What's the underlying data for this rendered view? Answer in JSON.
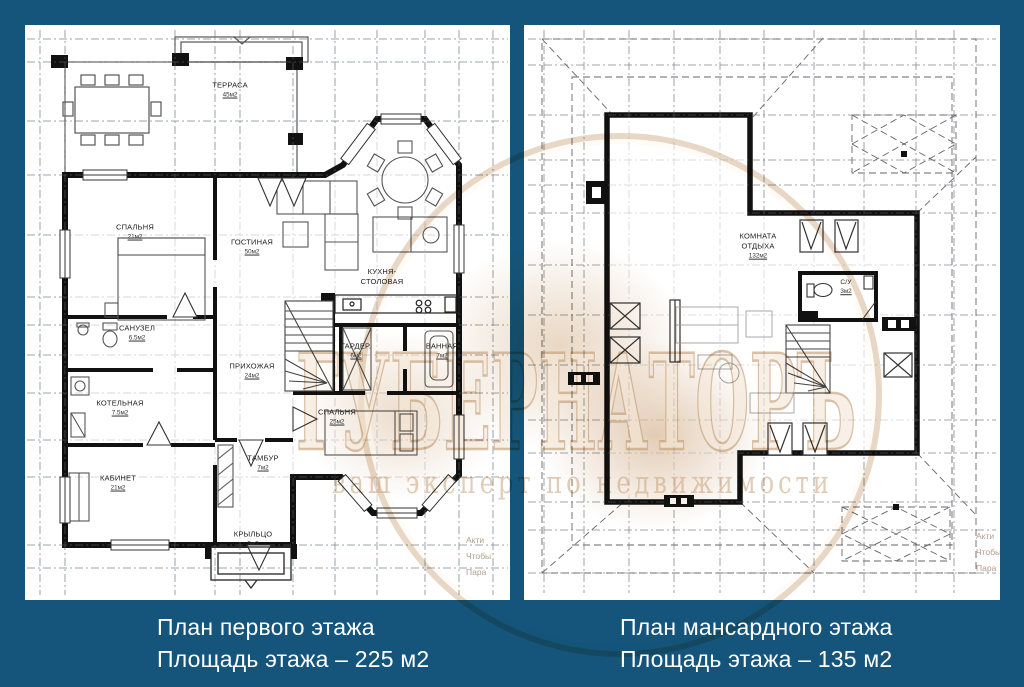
{
  "colors": {
    "background": "#15557C",
    "panel": "#FFFFFF",
    "walls": "#111111",
    "watermark_tan": "#C69C6E",
    "caption_text": "#FFFFFF"
  },
  "left_plan": {
    "caption_line1": "План первого этажа",
    "caption_line2": "Площадь этажа – 225 м2",
    "rooms": [
      {
        "name": "ТЕРРАСА",
        "area": "45м2"
      },
      {
        "name": "СПАЛЬНЯ",
        "area": "21м2"
      },
      {
        "name": "ГОСТИНАЯ",
        "area": "50м2"
      },
      {
        "name": "КУХНЯ-СТОЛОВАЯ",
        "area": ""
      },
      {
        "name": "САНУЗЕЛ",
        "area": "6.5м2"
      },
      {
        "name": "ПРИХОЖАЯ",
        "area": "24м2"
      },
      {
        "name": "ГАРДЕР.",
        "area": "6м2"
      },
      {
        "name": "ВАННАЯ",
        "area": "7м2"
      },
      {
        "name": "КОТЕЛЬНАЯ",
        "area": "7.5м2"
      },
      {
        "name": "СПАЛЬНЯ",
        "area": "25м2"
      },
      {
        "name": "КАБИНЕТ",
        "area": "21м2"
      },
      {
        "name": "ТАМБУР",
        "area": "7м2"
      },
      {
        "name": "КРЫЛЬЦО",
        "area": "5м2"
      }
    ]
  },
  "right_plan": {
    "caption_line1": "План мансардного этажа",
    "caption_line2": "Площадь этажа – 135 м2",
    "rooms": [
      {
        "name": "КОМНАТА ОТДЫХА",
        "area": "132м2"
      },
      {
        "name": "С/У",
        "area": "3м2"
      }
    ]
  },
  "watermark": {
    "brand": "ГУБЕРНАТОРЪ",
    "tagline": "ваш эксперт по недвижимости",
    "corner_note_lines": [
      "Акти",
      "Чтобы",
      "Пара"
    ]
  }
}
